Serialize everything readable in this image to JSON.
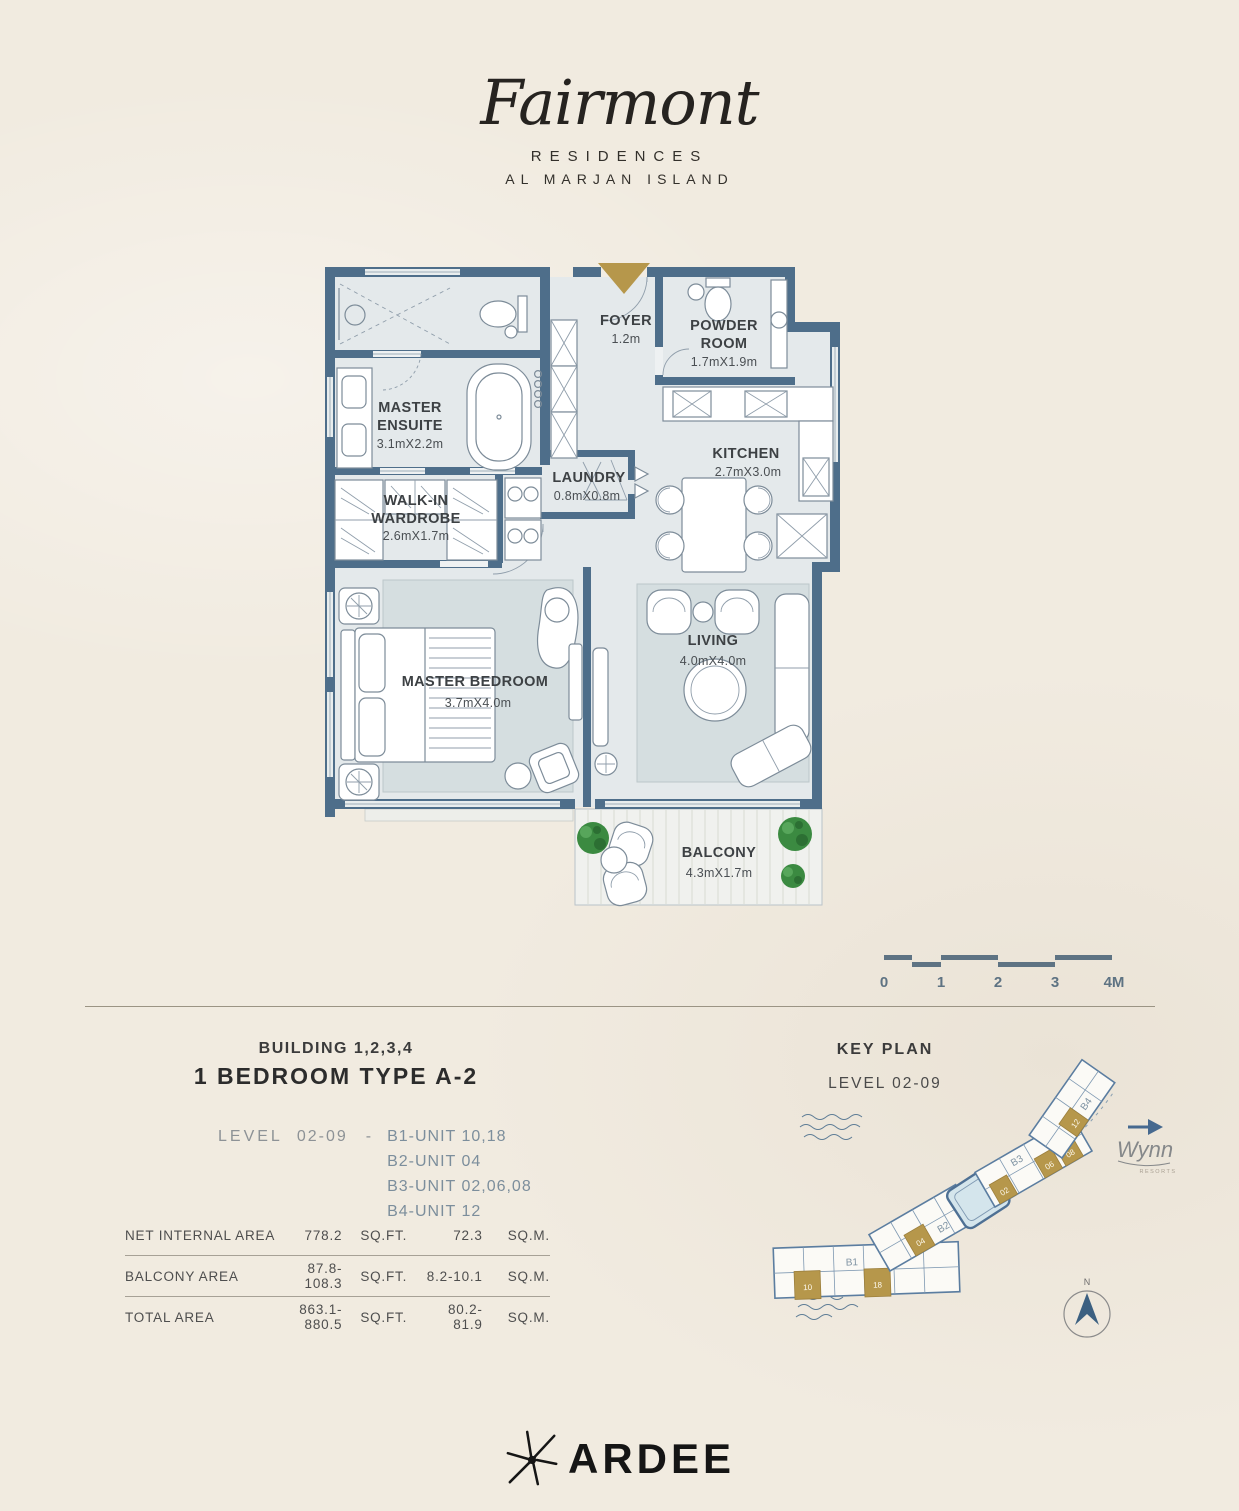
{
  "brand": {
    "name": "Fairmont",
    "line1": "RESIDENCES",
    "line2": "AL MARJAN ISLAND"
  },
  "floorplan": {
    "rooms": {
      "ensuite": {
        "line1": "MASTER",
        "line2": "ENSUITE",
        "dims": "3.1mX2.2m"
      },
      "foyer": {
        "line1": "FOYER",
        "dims": "1.2m"
      },
      "powder": {
        "line1": "POWDER",
        "line2": "ROOM",
        "dims": "1.7mX1.9m"
      },
      "laundry": {
        "line1": "LAUNDRY",
        "dims": "0.8mX0.8m"
      },
      "kitchen": {
        "line1": "KITCHEN",
        "dims": "2.7mX3.0m"
      },
      "wardrobe": {
        "line1": "WALK-IN",
        "line2": "WARDROBE",
        "dims": "2.6mX1.7m"
      },
      "bedroom": {
        "line1": "MASTER BEDROOM",
        "dims": "3.7mX4.0m"
      },
      "living": {
        "line1": "LIVING",
        "dims": "4.0mX4.0m"
      },
      "balcony": {
        "line1": "BALCONY",
        "dims": "4.3mX1.7m"
      }
    }
  },
  "scale_bar": {
    "labels": [
      "0",
      "1",
      "2",
      "3",
      "4M"
    ]
  },
  "unit_info": {
    "building": "BUILDING 1,2,3,4",
    "type": "1 BEDROOM TYPE A-2",
    "level_label": "LEVEL",
    "level_value": "02-09",
    "dash": "-",
    "units": [
      "B1-UNIT 10,18",
      "B2-UNIT 04",
      "B3-UNIT 02,06,08",
      "B4-UNIT 12"
    ]
  },
  "areas": {
    "rows": [
      {
        "label": "NET INTERNAL AREA",
        "sqft": "778.2",
        "sqft_unit": "SQ.FT.",
        "sqm": "72.3",
        "sqm_unit": "SQ.M."
      },
      {
        "label": "BALCONY AREA",
        "sqft": "87.8-108.3",
        "sqft_unit": "SQ.FT.",
        "sqm": "8.2-10.1",
        "sqm_unit": "SQ.M."
      },
      {
        "label": "TOTAL AREA",
        "sqft": "863.1-880.5",
        "sqft_unit": "SQ.FT.",
        "sqm": "80.2-81.9",
        "sqm_unit": "SQ.M."
      }
    ]
  },
  "key_plan": {
    "title": "KEY PLAN",
    "level": "LEVEL 02-09",
    "buildings": {
      "b1": "B1",
      "b2": "B2",
      "b3": "B3",
      "b4": "B4"
    },
    "highlight_labels": {
      "b1a": "10",
      "b1b": "18",
      "b2": "04",
      "b3a": "02",
      "b3b": "06",
      "b3c": "08",
      "b4": "12"
    },
    "wynn": "Wynn",
    "wynn_sub": "RESORTS",
    "north": "N"
  },
  "footer": {
    "developer": "ARDEE"
  },
  "colors": {
    "wall": "#4e6e8a",
    "gold": "#b6974b",
    "cream": "#f1ebe0",
    "floor": "#e4e9eb",
    "rug": "#d5dee0",
    "slate_text": "#7c8e9c",
    "plant_green": "#3b8a41"
  }
}
